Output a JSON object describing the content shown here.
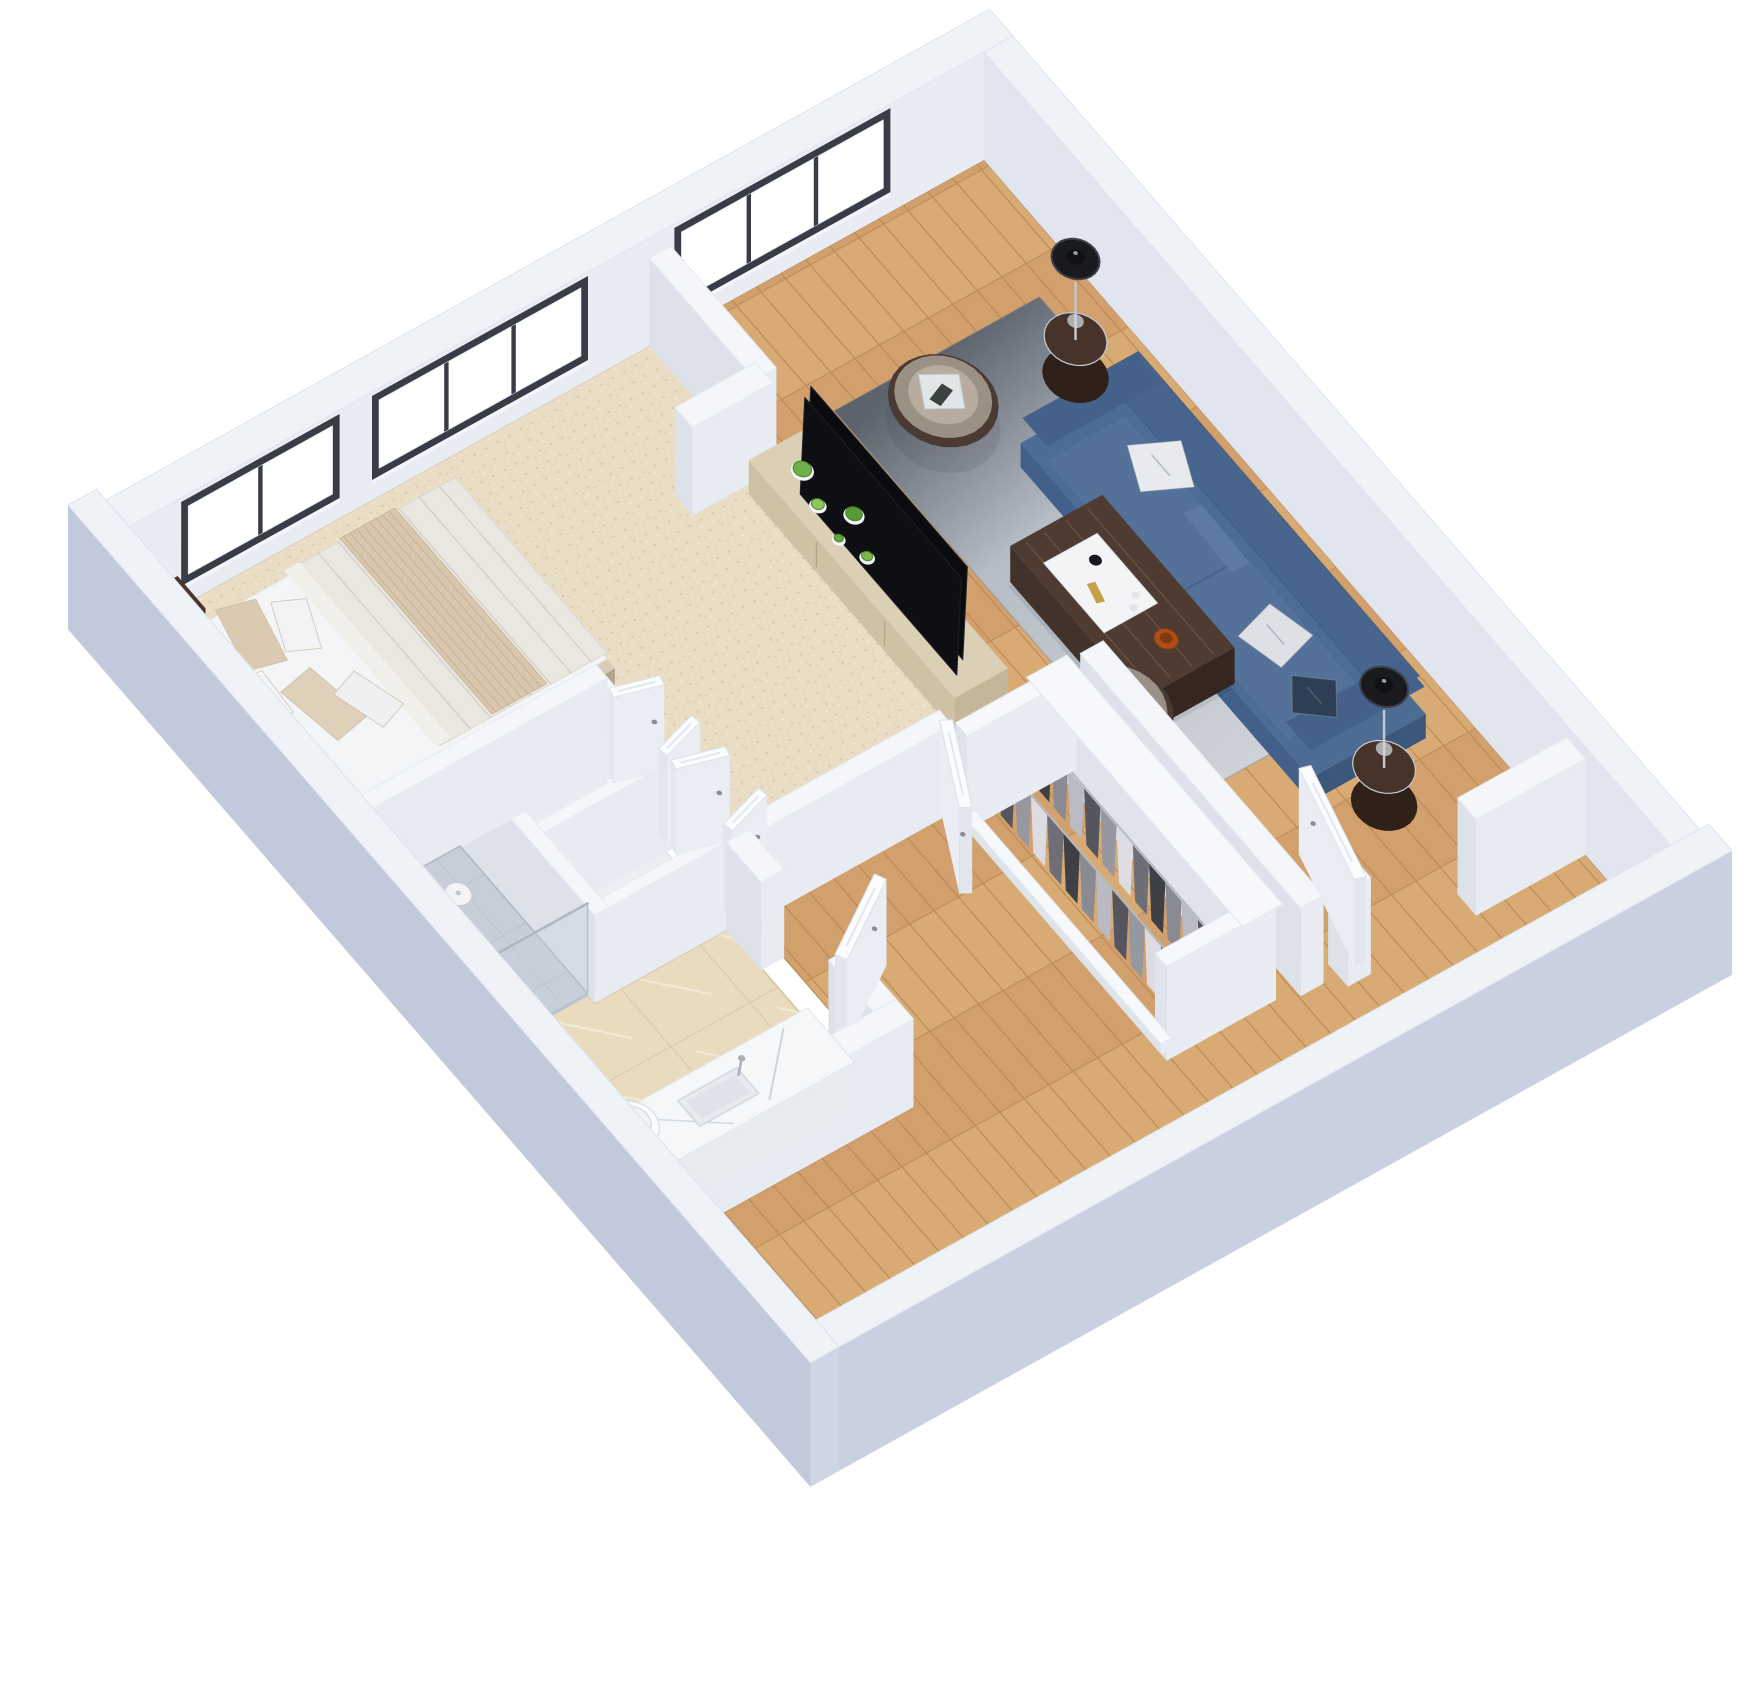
{
  "meta": {
    "description": "3D isometric dollhouse rendering of a one-bedroom apartment floor plan",
    "rooms": [
      "bedroom",
      "living-room",
      "entry-hall",
      "corridor",
      "closet",
      "bathroom",
      "shower"
    ]
  },
  "view": {
    "m": [
      0.58,
      0.67,
      -0.72,
      0.4,
      984,
      160
    ],
    "size": [
      1744,
      1696
    ]
  },
  "palette": {
    "background": "#ffffff",
    "wall_top": "#eff2f7",
    "wall_inner_nw": "#e9ecf3",
    "wall_inner_ne": "#e0e5ef",
    "wall_outer_se": "#c9d0e0",
    "wall_outer_sw": "#c2c9da",
    "wall_cap": "#cfd6e4",
    "interior_wall_top": "#f4f6fa",
    "interior_wall_side_x": "#e8ebf2",
    "interior_wall_side_y": "#dde1ea",
    "window_frame": "#383c46",
    "window_glass": "#ffffff",
    "wood_floor": "#d2a06c",
    "carpet": "#e9ddc5",
    "tile": "#e9dcbe",
    "shower_floor": "#c7ced9",
    "rug_dark": "#5d636d",
    "rug_light": "#ced2d9",
    "sofa_blue": "#4c6c93",
    "armchair_leather": "#9a9083",
    "armchair_trim": "#4b3a33",
    "walnut_dark": "#46332a",
    "console_beige": "#dbcfb6",
    "tv_black": "#0a0b0e",
    "door_white": "#fbfcfe",
    "fixture_white": "#fafbfd",
    "chrome": "#b7bdc8",
    "gold": "#c08d3e",
    "plant_green": "#6fb04a"
  },
  "floors": [
    {
      "name": "wood-floor",
      "fill": "url(#woodPat)",
      "stroke": "#c19366",
      "poly": [
        [
          0,
          0
        ],
        [
          1200,
          0
        ],
        [
          1200,
          1200
        ],
        [
          915,
          1200
        ],
        [
          915,
          835
        ],
        [
          635,
          835
        ],
        [
          635,
          450
        ],
        [
          0,
          450
        ]
      ]
    },
    {
      "name": "bedroom-carpet",
      "fill": "url(#carpetPat)",
      "stroke": "#d9caab",
      "poly": [
        [
          0,
          450
        ],
        [
          618,
          450
        ],
        [
          618,
          845
        ],
        [
          380,
          845
        ],
        [
          380,
          1200
        ],
        [
          0,
          1200
        ]
      ]
    },
    {
      "name": "closet-nook-floor",
      "fill": "#edeff4",
      "stroke": "#dde1e9",
      "poly": [
        [
          400,
          860
        ],
        [
          632,
          860
        ],
        [
          632,
          1040
        ],
        [
          400,
          1040
        ]
      ]
    },
    {
      "name": "bathroom-tile",
      "fill": "url(#tilePat)",
      "stroke": "#d3c2a0",
      "poly": [
        [
          632,
          865
        ],
        [
          885,
          865
        ],
        [
          885,
          1200
        ],
        [
          400,
          1200
        ],
        [
          400,
          1050
        ],
        [
          632,
          1050
        ]
      ]
    }
  ],
  "exterior": [
    {
      "name": "exterior-wall-nw",
      "rect": [
        -40,
        -40,
        0,
        1240
      ],
      "h": 108,
      "t": "wall_top",
      "sx": "wall_inner_nw",
      "sy": "wall_cap"
    },
    {
      "name": "exterior-wall-ne",
      "rect": [
        0,
        -40,
        1240,
        0
      ],
      "h": 108,
      "t": "wall_top",
      "sx": "wall_cap",
      "sy": "wall_inner_ne"
    }
  ],
  "near_walls": [
    {
      "name": "exterior-wall-se",
      "rect": [
        1200,
        -40,
        1240,
        1240
      ],
      "h": 124,
      "t": "wall_top",
      "sx": "wall_outer_se",
      "sy": "wall_cap"
    },
    {
      "name": "exterior-wall-sw",
      "rect": [
        -40,
        1200,
        1240,
        1240
      ],
      "h": 124,
      "t": "wall_top",
      "sx": "wall_cap",
      "sy": "wall_outer_sw"
    }
  ],
  "windows": [
    {
      "name": "living-room-window",
      "y": [
        140,
        420
      ],
      "panes": 3
    },
    {
      "name": "bedroom-window-large",
      "y": [
        560,
        840
      ],
      "panes": 3
    },
    {
      "name": "bedroom-window-small",
      "y": [
        905,
        1105
      ],
      "panes": 2
    }
  ],
  "items": [
    {
      "type": "rug",
      "name": "living-room-rug",
      "rect": [
        170,
        60,
        760,
        345
      ]
    },
    {
      "type": "sofa",
      "name": "sofa",
      "rect": [
        330,
        55,
        830,
        215
      ],
      "pillows": [
        [
          460,
          125,
          60,
          60,
          25,
          "#e8eaee"
        ],
        [
          695,
          155,
          58,
          58,
          -15,
          "#dde0e5"
        ],
        [
          778,
          168,
          48,
          48,
          38,
          "#2e3e55"
        ]
      ]
    },
    {
      "type": "sideTable",
      "name": "side-table-left",
      "c": [
        272,
        92
      ]
    },
    {
      "type": "tableLamp",
      "name": "table-lamp-left",
      "c": [
        272,
        92
      ]
    },
    {
      "type": "tubChair",
      "name": "armchair-top",
      "c": [
        250,
        258
      ],
      "ang": 30
    },
    {
      "type": "wall",
      "name": "partition-bedroom-living-a",
      "rect": [
        0,
        435,
        182,
        465
      ],
      "h": 88
    },
    {
      "type": "wall",
      "name": "partition-bedroom-living-b",
      "rect": [
        165,
        450,
        195,
        562
      ],
      "h": 88
    },
    {
      "type": "console",
      "name": "tv-console",
      "rect": [
        205,
        418,
        560,
        492
      ],
      "plants": [
        [
          248,
          452,
          10,
          "#6fb04a"
        ],
        [
          292,
          466,
          7,
          "#8cc75c"
        ],
        [
          322,
          440,
          9,
          "#569a36"
        ],
        [
          372,
          462,
          6,
          "#79b84a"
        ],
        [
          338,
          474,
          5,
          "#5fa73f"
        ]
      ]
    },
    {
      "type": "coffeeTable",
      "name": "coffee-table",
      "rect": [
        440,
        190,
        668,
        318
      ]
    },
    {
      "type": "sideTable",
      "name": "side-table-right",
      "c": [
        876,
        150
      ]
    },
    {
      "type": "tableLamp",
      "name": "table-lamp-right",
      "c": [
        876,
        150
      ]
    },
    {
      "type": "tubChair",
      "name": "armchair-bottom",
      "c": [
        660,
        345
      ],
      "ang": -20
    },
    {
      "type": "wall",
      "name": "entry-wall",
      "rect": [
        640,
        350,
        1020,
        382
      ],
      "h": 88
    },
    {
      "type": "wall",
      "name": "entry-jamb-top",
      "rect": [
        1005,
        0,
        1037,
        152
      ],
      "h": 96
    },
    {
      "type": "wall",
      "name": "entry-jamb-bottom",
      "rect": [
        1003,
        298,
        1037,
        330
      ],
      "h": 96
    },
    {
      "type": "door",
      "name": "entry-door",
      "hinge": [
        1021,
        300
      ],
      "ang": 195,
      "len": 148,
      "th": 7
    },
    {
      "type": "wardrobe",
      "name": "closet-wardrobe",
      "back": [
        650,
        408,
        1010,
        428
      ],
      "left": [
        646,
        408,
        666,
        560
      ],
      "right": [
        990,
        408,
        1010,
        560
      ],
      "plinth": [
        660,
        545,
        1000,
        560
      ],
      "top": [
        642,
        402,
        1014,
        458
      ],
      "rows": [
        {
          "y": 470,
          "x0": 672,
          "n": 11,
          "step": 28
        },
        {
          "y": 526,
          "x0": 678,
          "n": 11,
          "step": 28
        }
      ],
      "clothes": [
        "#3f3f46",
        "#8a8a92",
        "#b9bac2",
        "#55555e",
        "#97979f",
        "#dcdce2",
        "#6e6e77"
      ]
    },
    {
      "type": "wall",
      "name": "corridor-wall",
      "rect": [
        618,
        560,
        640,
        845
      ],
      "h": 88
    },
    {
      "type": "door",
      "name": "bedroom-door",
      "hinge": [
        630,
        560
      ],
      "ang": 28,
      "len": 112,
      "th": 7
    },
    {
      "type": "bed",
      "name": "bed",
      "platform": [
        48,
        772,
        322,
        1190
      ],
      "mattress": [
        54,
        778,
        316,
        1186
      ],
      "duvet": [
        54,
        778,
        316,
        1010
      ],
      "fold": [
        54,
        995,
        316,
        1016
      ],
      "throw": [
        54,
        862,
        316,
        938
      ],
      "pillows": [
        [
          105,
          1102,
          82,
          48,
          14,
          "#dbcab2"
        ],
        [
          215,
          1090,
          82,
          48,
          -10,
          "#dfd0ba"
        ],
        [
          120,
          1052,
          64,
          40,
          24,
          "#f2f3f4"
        ],
        [
          235,
          1044,
          64,
          40,
          -18,
          "#eff0f2"
        ],
        [
          175,
          1142,
          60,
          38,
          4,
          "#f4f5f6"
        ]
      ],
      "headboard": [
        38,
        1188,
        332,
        1206
      ]
    },
    {
      "type": "nightstand",
      "name": "nightstand-left",
      "rect": [
        0,
        1120,
        48,
        1192
      ]
    },
    {
      "type": "ringLamp",
      "name": "ring-lamp-left",
      "c": [
        24,
        1156
      ]
    },
    {
      "type": "nightstand",
      "name": "nightstand-right",
      "rect": [
        332,
        1120,
        380,
        1192
      ]
    },
    {
      "type": "ringLamp",
      "name": "ring-lamp-right",
      "c": [
        356,
        1156
      ]
    },
    {
      "type": "wall",
      "name": "closet-post-1",
      "rect": [
        400,
        845,
        415,
        1042
      ],
      "h": 88
    },
    {
      "type": "wall",
      "name": "closet-post-2",
      "rect": [
        506,
        845,
        520,
        1042
      ],
      "h": 88
    },
    {
      "type": "wall",
      "name": "closet-post-3",
      "rect": [
        618,
        845,
        632,
        1042
      ],
      "h": 88
    },
    {
      "type": "wall",
      "name": "closet-back-wall",
      "rect": [
        400,
        1030,
        632,
        1050
      ],
      "h": 88
    },
    {
      "type": "door",
      "name": "closet-door-1a",
      "hinge": [
        415,
        852
      ],
      "ang": 285,
      "len": 60,
      "th": 6
    },
    {
      "type": "door",
      "name": "closet-door-1b",
      "hinge": [
        504,
        852
      ],
      "ang": 255,
      "len": 60,
      "th": 6
    },
    {
      "type": "door",
      "name": "closet-door-2a",
      "hinge": [
        522,
        852
      ],
      "ang": 285,
      "len": 64,
      "th": 6
    },
    {
      "type": "door",
      "name": "closet-door-2b",
      "hinge": [
        616,
        852
      ],
      "ang": 255,
      "len": 64,
      "th": 6
    },
    {
      "type": "wall",
      "name": "bathroom-wall-left",
      "rect": [
        632,
        835,
        692,
        867
      ],
      "h": 88
    },
    {
      "type": "wall",
      "name": "bathroom-wall-right",
      "rect": [
        808,
        835,
        885,
        867
      ],
      "h": 88
    },
    {
      "type": "door",
      "name": "bathroom-door",
      "hinge": [
        810,
        851
      ],
      "ang": 240,
      "len": 118,
      "th": 7
    },
    {
      "type": "wall",
      "name": "bathroom-wall-west",
      "rect": [
        380,
        845,
        400,
        1200
      ],
      "h": 88
    },
    {
      "type": "showerFloor",
      "name": "shower",
      "floor": [
        400,
        1050,
        620,
        1200
      ]
    },
    {
      "type": "tub",
      "name": "bathtub",
      "rim": [
        405,
        1128,
        615,
        1198
      ],
      "basin": [
        422,
        1140,
        598,
        1190
      ]
    },
    {
      "type": "showerFix",
      "name": "shower-fixtures",
      "glass": [
        620,
        1050,
        620,
        1200
      ],
      "pole": [
        532,
        1158
      ],
      "head": [
        536,
        1162
      ],
      "drain": [
        450,
        1112
      ]
    },
    {
      "type": "wall",
      "name": "bathroom-wall-east",
      "rect": [
        885,
        835,
        915,
        1200
      ],
      "h": 88
    },
    {
      "type": "vanity",
      "name": "vanity",
      "body": [
        815,
        902,
        885,
        1195
      ],
      "counter": [
        808,
        896,
        889,
        1200
      ],
      "sink": [
        830,
        1012,
        868,
        1094
      ],
      "faucet": [
        826,
        1002
      ]
    },
    {
      "type": "toilet",
      "name": "toilet",
      "bowl": [
        793,
        1128
      ],
      "tank": [
        763,
        1168,
        828,
        1198
      ]
    }
  ]
}
